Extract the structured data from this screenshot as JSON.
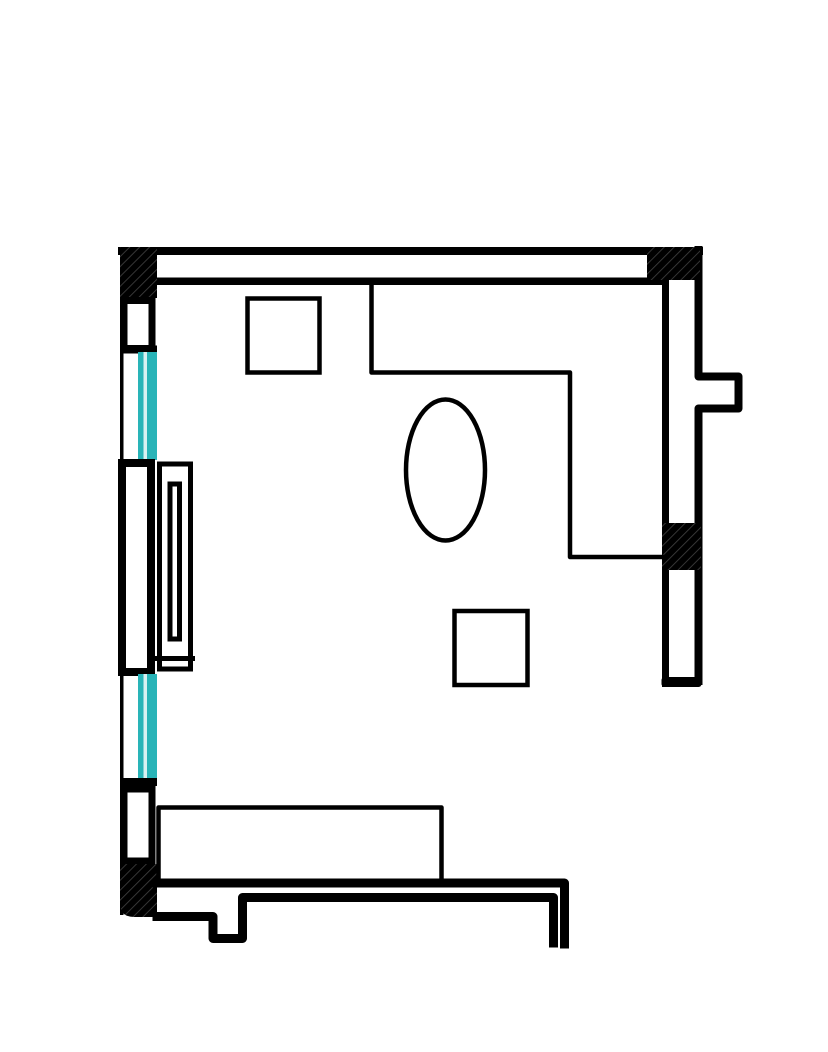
{
  "document": {
    "title": "Room floor plan drawing",
    "type": "architectural-floor-plan",
    "visible_text": []
  },
  "canvas": {
    "width": 828,
    "height": 1052,
    "background": "#ffffff"
  },
  "palette": {
    "ink": "#000000",
    "white": "#ffffff",
    "glass": "#29b4b8",
    "glass_highlight": "#d9f1f2",
    "hatch_line": "#3f3f3f",
    "none": "none"
  },
  "hatch": {
    "size": 7,
    "line_width": 1.7,
    "angle": 45
  },
  "shapes": [
    {
      "name": "top-wall-outer-band",
      "kind": "rect",
      "x": 118,
      "y": 247,
      "w": 585,
      "h": 8,
      "fill": "ink"
    },
    {
      "name": "top-wall-inner-band",
      "kind": "rect",
      "x": 157,
      "y": 277.5,
      "w": 508,
      "h": 7.5,
      "fill": "ink"
    },
    {
      "name": "left-wall-outer-line",
      "kind": "rect",
      "x": 120,
      "y": 250,
      "w": 3.5,
      "h": 665,
      "fill": "ink"
    },
    {
      "name": "corner-hatch-top-left",
      "kind": "rect",
      "x": 120,
      "y": 247,
      "w": 37,
      "h": 51,
      "fill": "hatch"
    },
    {
      "name": "left-wall-segment-upper",
      "kind": "rect",
      "x": 124,
      "y": 300.5,
      "w": 28,
      "h": 48,
      "fill": "white",
      "stroke": "ink",
      "sw": 7
    },
    {
      "name": "window-sill-upper",
      "kind": "rect",
      "x": 120,
      "y": 345.5,
      "w": 37,
      "h": 8,
      "fill": "ink"
    },
    {
      "name": "window-upper-glass",
      "kind": "rect",
      "x": 138,
      "y": 352,
      "w": 19,
      "h": 108,
      "fill": "glass"
    },
    {
      "name": "window-upper-glass-stripe",
      "kind": "rect",
      "x": 143.5,
      "y": 352,
      "w": 3.5,
      "h": 108,
      "fill": "glass_highlight"
    },
    {
      "name": "left-wall-pier",
      "kind": "rect",
      "x": 122,
      "y": 463,
      "w": 29,
      "h": 209,
      "fill": "white",
      "stroke": "ink",
      "sw": 8
    },
    {
      "name": "window-lower-glass",
      "kind": "rect",
      "x": 138,
      "y": 674,
      "w": 19,
      "h": 105,
      "fill": "glass"
    },
    {
      "name": "window-lower-glass-stripe",
      "kind": "rect",
      "x": 143.5,
      "y": 674,
      "w": 3.5,
      "h": 105,
      "fill": "glass_highlight"
    },
    {
      "name": "window-sill-lower",
      "kind": "rect",
      "x": 120,
      "y": 778,
      "w": 37,
      "h": 8,
      "fill": "ink"
    },
    {
      "name": "left-wall-segment-lower",
      "kind": "rect",
      "x": 124,
      "y": 789,
      "w": 28,
      "h": 72,
      "fill": "white",
      "stroke": "ink",
      "sw": 7
    },
    {
      "name": "corner-hatch-bottom-left",
      "kind": "path",
      "d": "M 120,864 H 157 V 917 H 134 Q 120,917 120,903 Z",
      "fill": "hatch"
    },
    {
      "name": "right-wall-inner-line",
      "kind": "rect",
      "x": 662,
      "y": 277,
      "w": 7,
      "h": 410,
      "fill": "ink"
    },
    {
      "name": "right-wall-outer-line",
      "kind": "path",
      "d": "M 698.5,250 V 376.5 H 738.5 V 408.5 H 698.5 V 681",
      "fill": "none",
      "stroke": "ink",
      "sw": 8,
      "join": "round"
    },
    {
      "name": "corner-hatch-top-right",
      "kind": "rect",
      "x": 647,
      "y": 247,
      "w": 53,
      "h": 33,
      "fill": "hatch"
    },
    {
      "name": "right-wall-hatch-block",
      "kind": "rect",
      "x": 662,
      "y": 523,
      "w": 39,
      "h": 47,
      "fill": "hatch"
    },
    {
      "name": "right-wall-end-cap",
      "kind": "rect",
      "x": 661.5,
      "y": 677,
      "w": 40,
      "h": 10,
      "rx": 3,
      "fill": "ink"
    },
    {
      "name": "bottom-wall-outer-line",
      "kind": "path",
      "d": "M 157,883 H 564.5 V 944",
      "fill": "none",
      "stroke": "ink",
      "sw": 9,
      "join": "round"
    },
    {
      "name": "bottom-wall-inner-line-with-step",
      "kind": "path",
      "d": "M 157,916.5 H 213 V 938.5 H 242.5 V 897.5 H 553.5 V 943",
      "fill": "none",
      "stroke": "ink",
      "sw": 9,
      "join": "round"
    },
    {
      "name": "counter-outline",
      "kind": "path",
      "d": "M 371.5,284 V 372.5 H 570 V 557 H 662",
      "fill": "none",
      "stroke": "ink",
      "sw": 4.5,
      "join": "round"
    },
    {
      "name": "table-square-upper",
      "kind": "rect",
      "x": 247.5,
      "y": 298.5,
      "w": 72,
      "h": 74,
      "fill": "none",
      "stroke": "ink",
      "sw": 4.5
    },
    {
      "name": "table-oval",
      "kind": "ellipse",
      "cx": 445.5,
      "cy": 470,
      "rx": 39.5,
      "ry": 70.5,
      "fill": "none",
      "stroke": "ink",
      "sw": 4.5
    },
    {
      "name": "table-square-center",
      "kind": "rect",
      "x": 454.5,
      "y": 611,
      "w": 73,
      "h": 74,
      "fill": "none",
      "stroke": "ink",
      "sw": 4.5
    },
    {
      "name": "bench-outline",
      "kind": "path",
      "d": "M 158.5,881 V 807.5 H 441.5 V 881",
      "fill": "none",
      "stroke": "ink",
      "sw": 4.5,
      "join": "round"
    },
    {
      "name": "radiator-outer",
      "kind": "rect",
      "x": 159.5,
      "y": 464,
      "w": 31,
      "h": 205,
      "fill": "white",
      "stroke": "ink",
      "sw": 5
    },
    {
      "name": "radiator-inner",
      "kind": "rect",
      "x": 170,
      "y": 484,
      "w": 9.5,
      "h": 155,
      "fill": "none",
      "stroke": "ink",
      "sw": 5
    },
    {
      "name": "radiator-divider",
      "kind": "line",
      "x1": 157,
      "y1": 658.5,
      "x2": 192.5,
      "y2": 658.5,
      "stroke": "ink",
      "sw": 5
    }
  ]
}
